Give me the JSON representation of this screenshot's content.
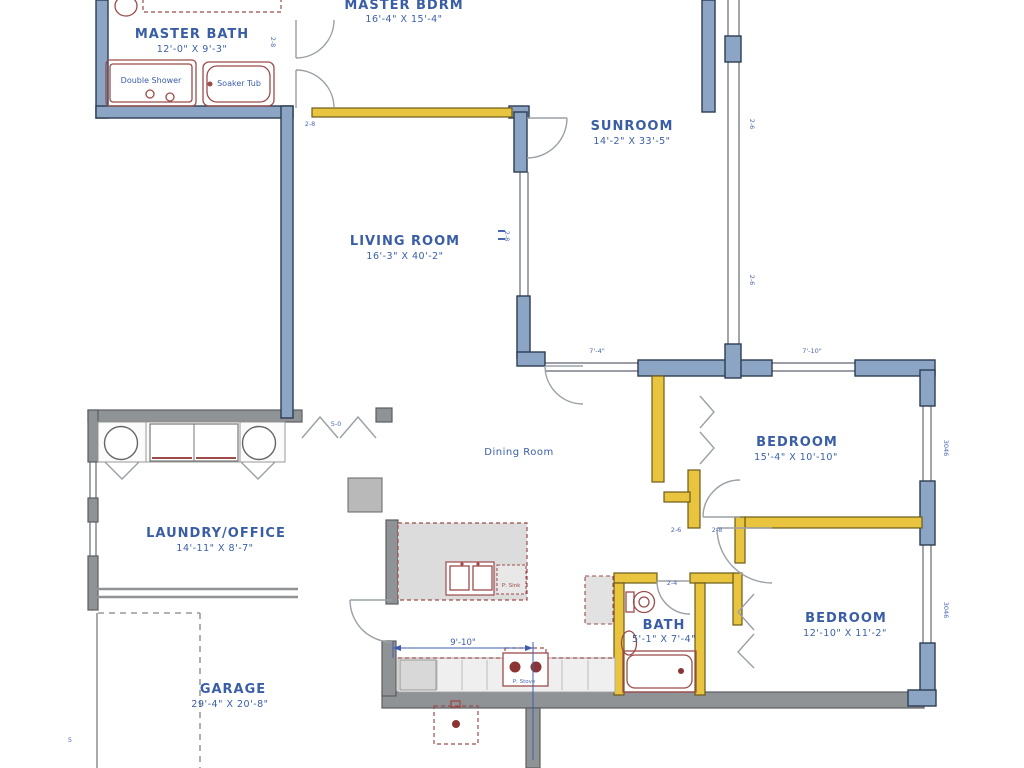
{
  "rooms": {
    "master_bath": {
      "name": "MASTER BATH",
      "dims": "12'-0\" X 9'-3\""
    },
    "master_bdrm": {
      "name": "MASTER BDRM",
      "dims": "16'-4\" X 15'-4\""
    },
    "sunroom": {
      "name": "SUNROOM",
      "dims": "14'-2\" X 33'-5\""
    },
    "living": {
      "name": "LIVING ROOM",
      "dims": "16'-3\" X 40'-2\""
    },
    "dining": {
      "name": "Dining Room"
    },
    "laundry": {
      "name": "LAUNDRY/OFFICE",
      "dims": "14'-11\" X 8'-7\""
    },
    "bedroom1": {
      "name": "BEDROOM",
      "dims": "15'-4\" X 10'-10\""
    },
    "bedroom2": {
      "name": "BEDROOM",
      "dims": "12'-10\" X 11'-2\""
    },
    "bath": {
      "name": "BATH",
      "dims": "5'-1\" X 7'-4\""
    },
    "garage": {
      "name": "GARAGE",
      "dims": "29'-4\" X 20'-8\""
    }
  },
  "fixtures": {
    "double_shower": "Double Shower",
    "soaker_tub": "Soaker Tub",
    "sink_note": "P: Sink",
    "stove_note": "P: Stove"
  },
  "dimensions": {
    "kitchen_width": "9'-10\"",
    "top_window_left": "7'-4\"",
    "top_window_right": "7'-10\"",
    "right_window_1": "3046",
    "right_window_2": "3046",
    "sunroom_window_1": "2-6",
    "sunroom_window_2": "2-6",
    "living_window": "2-8",
    "mbath_window": "2-8",
    "mbr_door": "2-8",
    "closet_door": "5-0",
    "b1_door": "2-6",
    "b1_door2": "2-8",
    "bath_door": "2-4",
    "garage_side": "5"
  },
  "colors": {
    "wall_new": "#8da5c4",
    "wall_interior": "#e9c53f",
    "wall_existing": "#909396",
    "fixture": "#9c4a4a",
    "label": "#3a5ea6"
  }
}
